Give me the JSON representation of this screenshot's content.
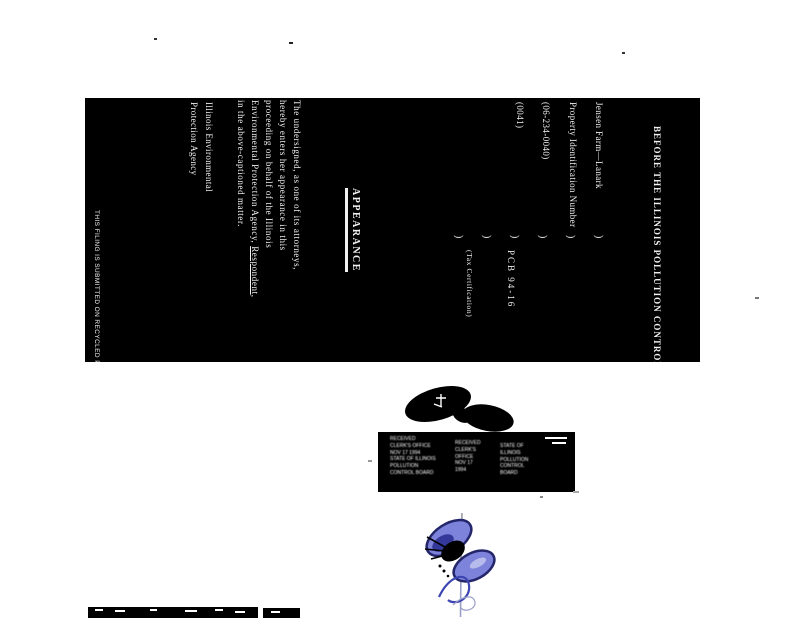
{
  "document": {
    "heading": "BEFORE THE ILLINOIS POLLUTION CONTROL BOARD",
    "caption": {
      "left_lines": [
        "Jensen Farm—Lanark",
        "Property Identification Number",
        "(06-234-0040)",
        "(0041)"
      ],
      "separator": ")",
      "docket_number": "PCB 94-16",
      "docket_type": "(Tax Certification)"
    },
    "title": "APPEARANCE",
    "body": {
      "line1": "The undersigned, as one of its attorneys,",
      "line2": "hereby enters her appearance in this",
      "line3": "proceeding on behalf of the Illinois",
      "line4_pre": "Environmental Protection Agency, ",
      "line4_u": "Respondent",
      "line4_post": ",",
      "line5": "in the above-captioned matter."
    },
    "signature_line1": "Illinois Environmental",
    "signature_line2": "Protection Agency",
    "footer": "THIS FILING IS SUBMITTED ON RECYCLED PAPER"
  },
  "stamp": {
    "cluster_a": [
      "RECEIVED",
      "CLERK'S OFFICE",
      "NOV 17 1994",
      "STATE OF ILLINOIS",
      "POLLUTION",
      "CONTROL BOARD"
    ],
    "cluster_b": [
      "RECEIVED",
      "CLERK'S",
      "OFFICE",
      "NOV 17",
      "1994"
    ],
    "cluster_c": [
      "STATE OF",
      "ILLINOIS",
      "POLLUTION",
      "CONTROL",
      "BOARD"
    ]
  },
  "graphics": {
    "butterfly": {
      "wing_fill": "#7d82da",
      "wing_edge": "#23266a",
      "wing_shadow": "#34389b",
      "body_color": "#000000",
      "flourish_color": "#3d45b2",
      "faint_color": "#9aa0c8",
      "pin_color": "#9a9aa8"
    },
    "blob_color": "#000000",
    "scan_background": "#000000",
    "page_background": "#ffffff"
  }
}
